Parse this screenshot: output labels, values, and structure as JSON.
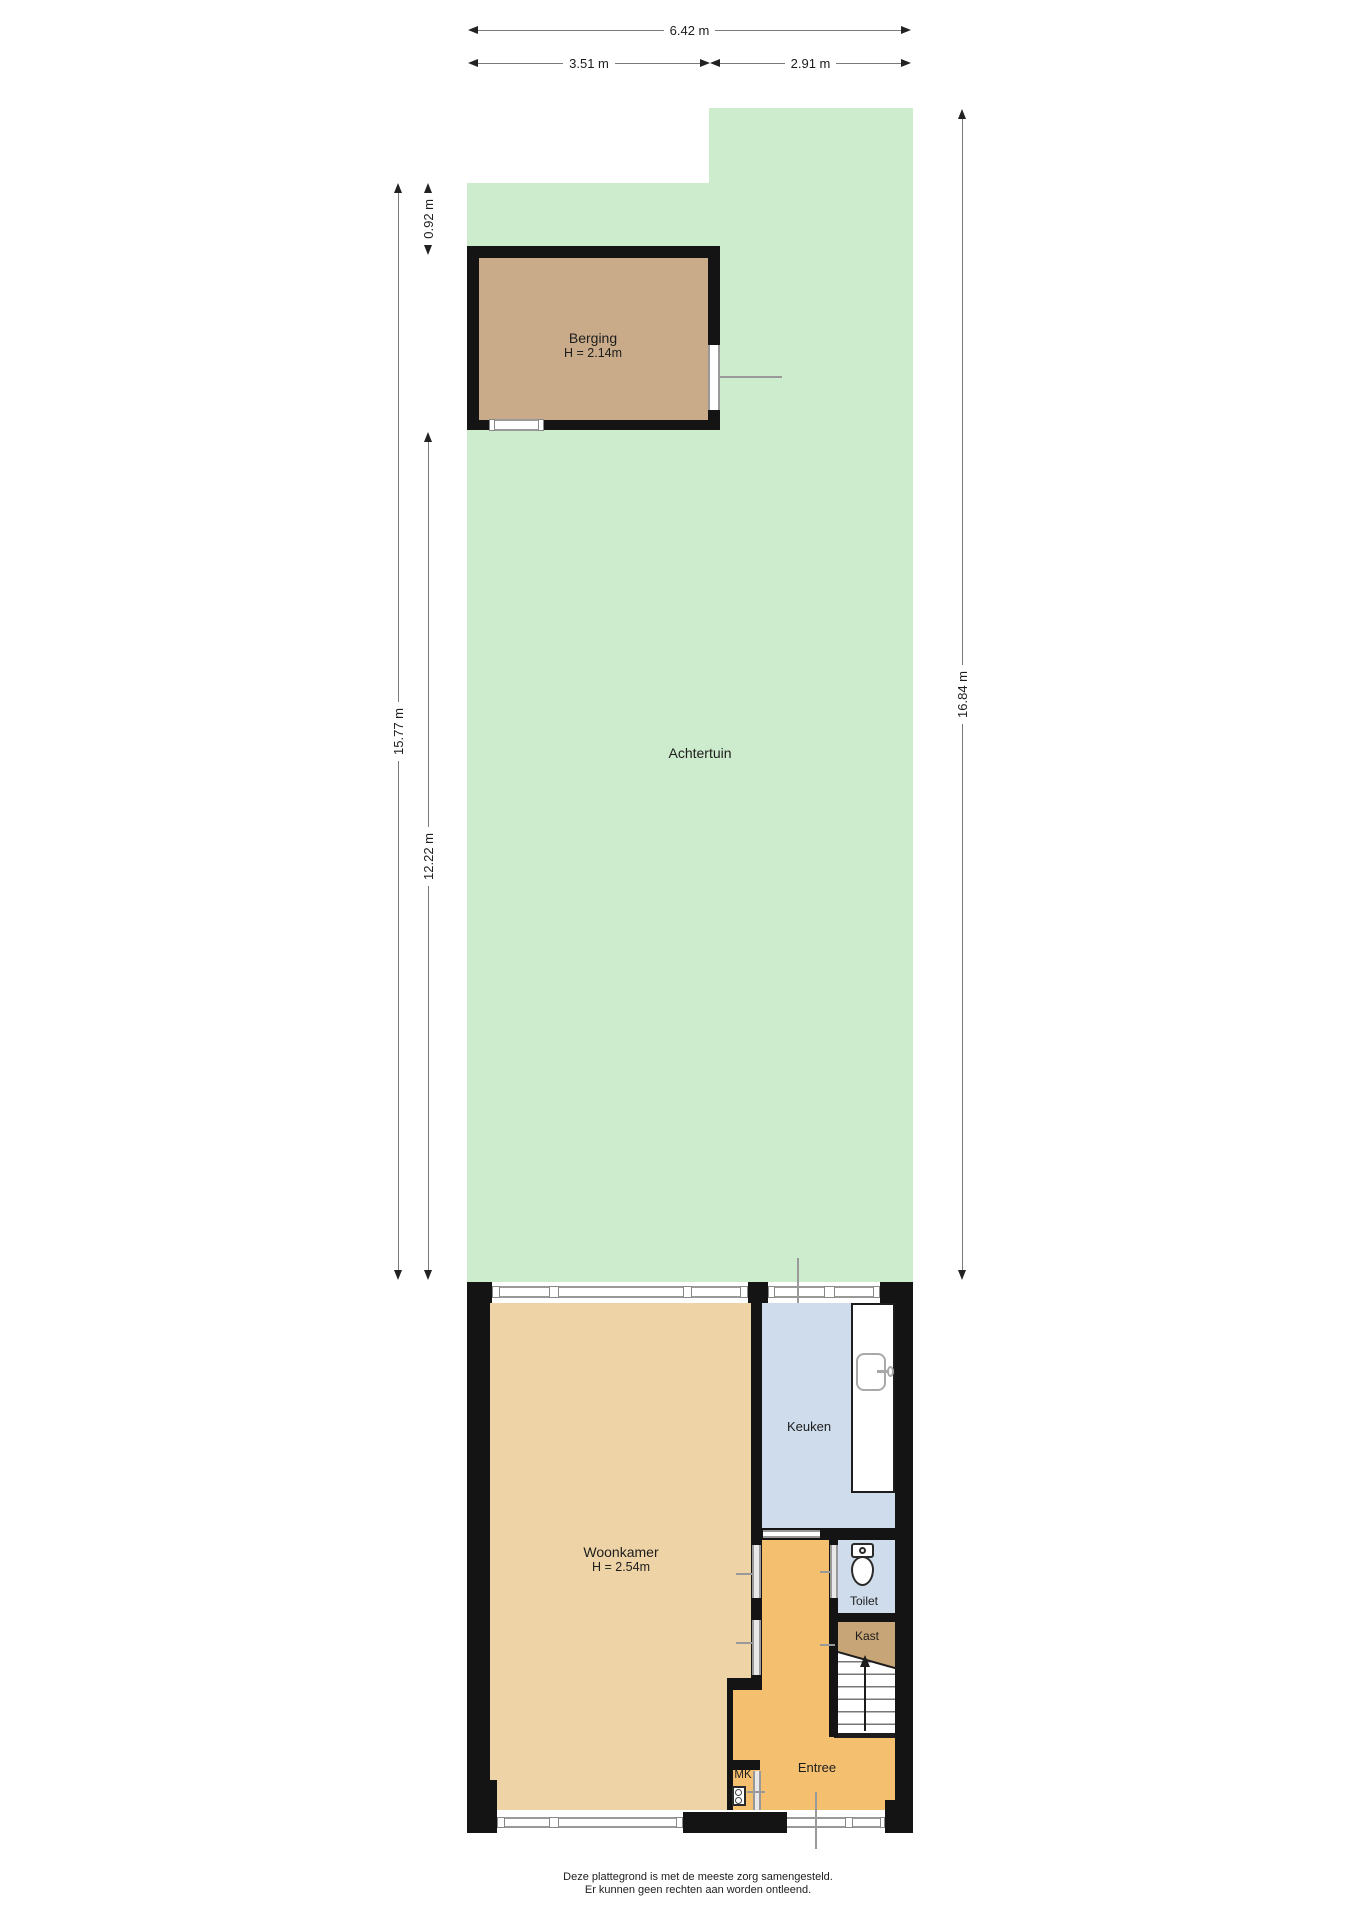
{
  "floorplan": {
    "dimensions": {
      "top_total": "6.42 m",
      "top_left": "3.51 m",
      "top_right": "2.91 m",
      "left_full": "15.77 m",
      "left_shed_gap": "0.92 m",
      "left_garden": "12.22 m",
      "right_garden": "16.84 m"
    },
    "rooms": {
      "garden": {
        "label": "Achtertuin"
      },
      "shed": {
        "label": "Berging",
        "height": "H = 2.14m"
      },
      "living": {
        "label": "Woonkamer",
        "height": "H = 2.54m"
      },
      "kitchen": {
        "label": "Keuken"
      },
      "toilet": {
        "label": "Toilet"
      },
      "closet": {
        "label": "Kast"
      },
      "entry": {
        "label": "Entree"
      },
      "meter_closet": {
        "label": "MK"
      }
    },
    "disclaimer": {
      "line1": "Deze plattegrond is met de meeste zorg samengesteld.",
      "line2": "Er kunnen geen rechten aan worden ontleend."
    },
    "colors": {
      "garden": "#cdeccd",
      "shed_floor": "#c9ab89",
      "living_floor": "#eed3a6",
      "entry_floor": "#f5bf70",
      "closet_floor": "#c8a576",
      "kitchen_floor": "#cfdceb",
      "toilet_floor": "#cfdceb",
      "wall": "#141414",
      "window_frame": "#999999"
    }
  }
}
